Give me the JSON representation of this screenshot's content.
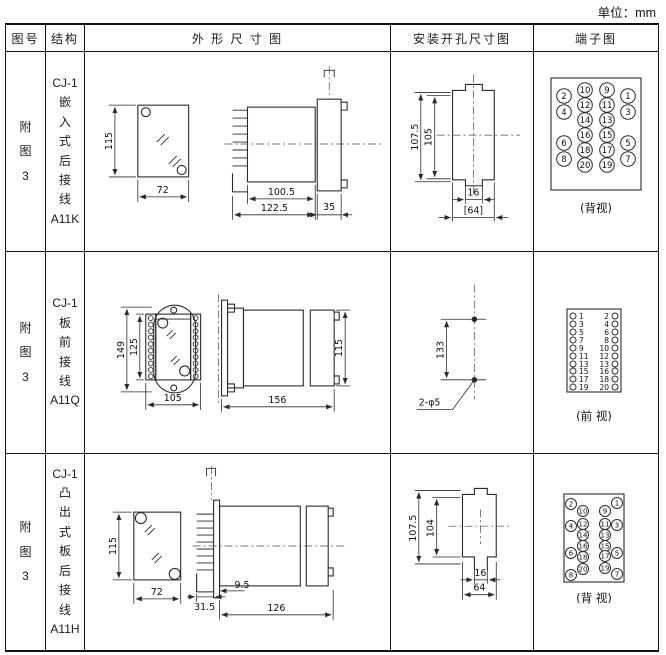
{
  "unit_label": "单位：mm",
  "header": {
    "figure": "图号",
    "structure": "结构",
    "outline": "外 形 尺 寸 图",
    "mounting": "安装开孔尺寸图",
    "terminal": "端子图"
  },
  "rows": [
    {
      "figure": "附\n图\n3",
      "structure": "CJ-1\n嵌\n入\n式\n后\n接\n线\nA11K",
      "outline": {
        "height": "115",
        "width": "72",
        "depth_body": "100.5",
        "depth_total": "122.5",
        "flange": "35"
      },
      "mounting": {
        "outer_height": "107.5",
        "inner_height": "105",
        "notch_width": "16",
        "span": "[64]"
      },
      "terminal": {
        "caption": "(背视)",
        "numbers": [
          "2",
          "10",
          "9",
          "1",
          "4",
          "12",
          "11",
          "3",
          "14",
          "13",
          "6",
          "16",
          "15",
          "5",
          "8",
          "18",
          "17",
          "7",
          "20",
          "19"
        ]
      }
    },
    {
      "figure": "附\n图\n3",
      "structure": "CJ-1\n板\n前\n接\n线\nA11Q",
      "outline": {
        "outer_height": "149",
        "inner_height": "125",
        "width": "105",
        "depth": "156",
        "side_height": "115"
      },
      "mounting": {
        "hole_spacing": "133",
        "holes_label": "2-φ5"
      },
      "terminal": {
        "caption": "(前 视)",
        "left": [
          "1",
          "3",
          "5",
          "7",
          "9",
          "11",
          "13",
          "15",
          "17",
          "19"
        ],
        "right": [
          "2",
          "4",
          "6",
          "8",
          "10",
          "12",
          "13",
          "16",
          "18",
          "20"
        ]
      }
    },
    {
      "figure": "附\n图\n3",
      "structure": "CJ-1\n凸\n出\n式\n板\n后\n接\n线\nA11H",
      "outline": {
        "height": "115",
        "width": "72",
        "pin_depth": "31.5",
        "panel_thickness": "9.5",
        "depth": "126"
      },
      "mounting": {
        "outer_height": "107.5",
        "inner_height": "104",
        "notch_width": "16",
        "span": "64"
      },
      "terminal": {
        "caption": "(背 视)",
        "numbers": [
          "2",
          "1",
          "10",
          "9",
          "4",
          "12",
          "11",
          "3",
          "14",
          "13",
          "16",
          "15",
          "6",
          "18",
          "17",
          "5",
          "20",
          "19",
          "8",
          "7"
        ]
      }
    }
  ]
}
